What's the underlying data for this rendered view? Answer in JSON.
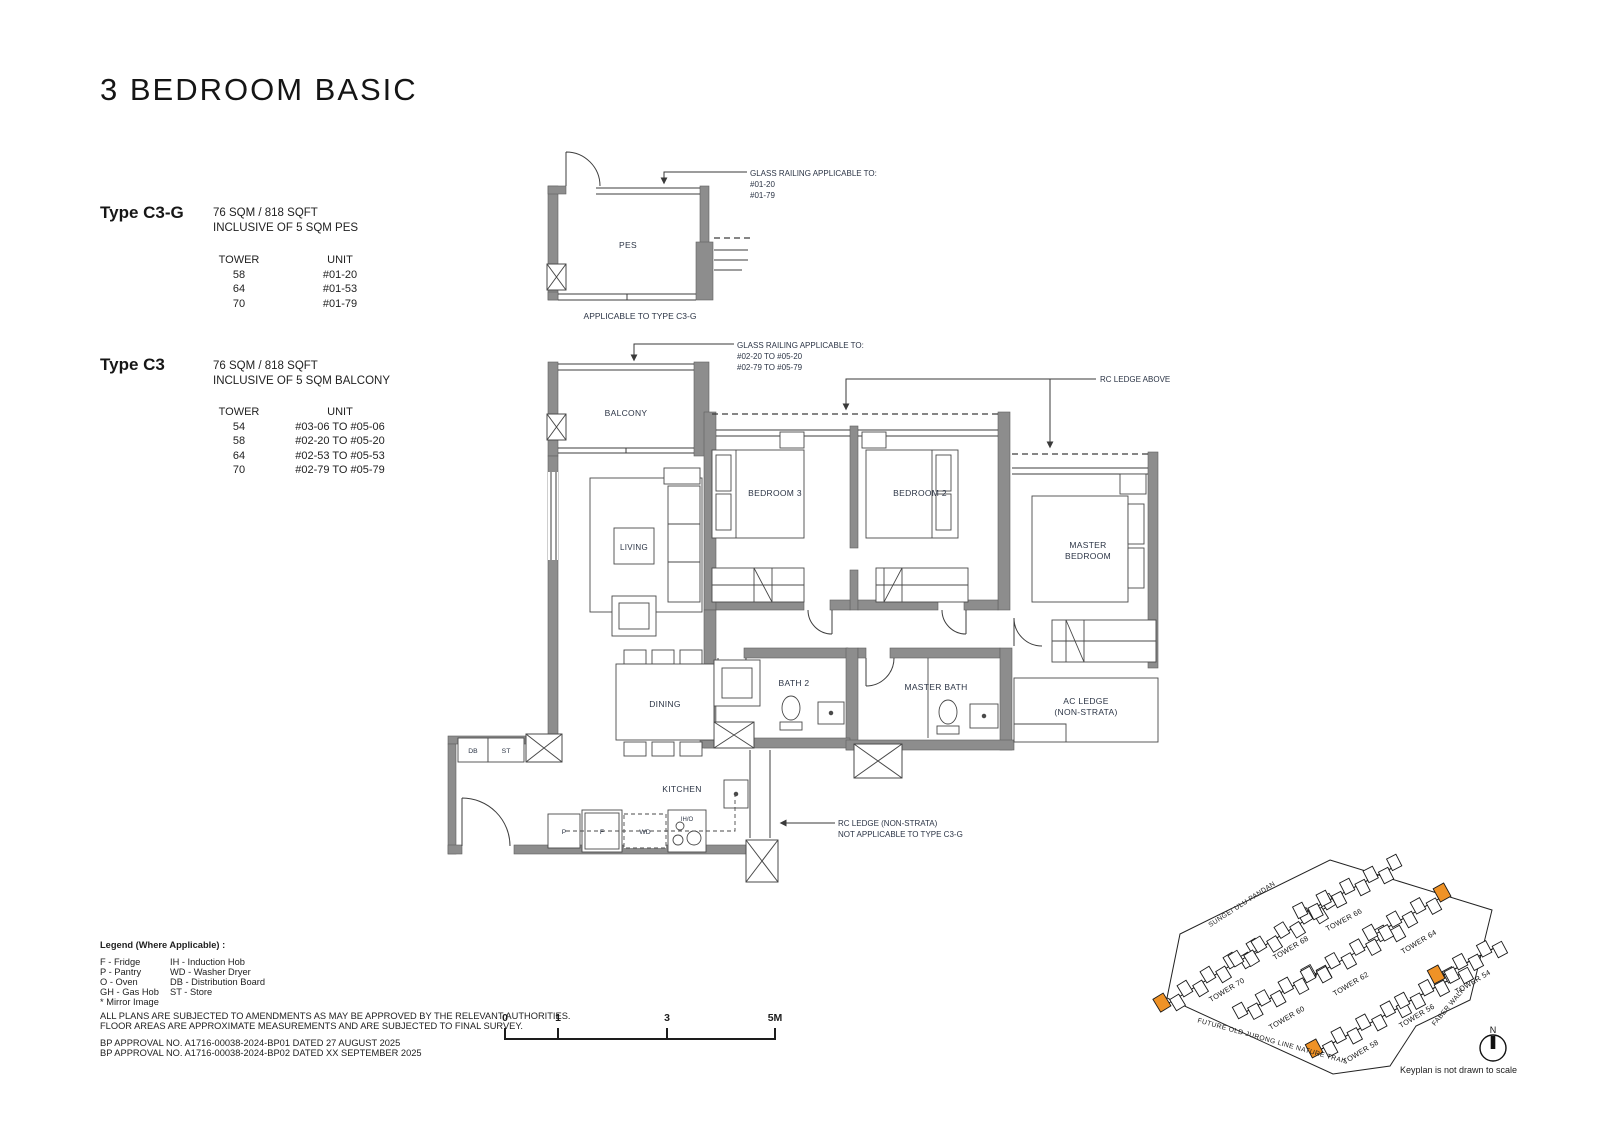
{
  "title": "3 BEDROOM BASIC",
  "unit_types": [
    {
      "name": "Type C3-G",
      "area": "76 SQM / 818 SQFT",
      "inclusive": "INCLUSIVE OF 5 SQM PES",
      "headers": {
        "tower": "TOWER",
        "unit": "UNIT"
      },
      "rows": [
        {
          "tower": "58",
          "unit": "#01-20"
        },
        {
          "tower": "64",
          "unit": "#01-53"
        },
        {
          "tower": "70",
          "unit": "#01-79"
        }
      ]
    },
    {
      "name": "Type C3",
      "area": "76 SQM / 818 SQFT",
      "inclusive": "INCLUSIVE OF 5 SQM BALCONY",
      "headers": {
        "tower": "TOWER",
        "unit": "UNIT"
      },
      "rows": [
        {
          "tower": "54",
          "unit": "#03-06 TO #05-06"
        },
        {
          "tower": "58",
          "unit": "#02-20 TO #05-20"
        },
        {
          "tower": "64",
          "unit": "#02-53 TO #05-53"
        },
        {
          "tower": "70",
          "unit": "#02-79 TO #05-79"
        }
      ]
    }
  ],
  "floorplan": {
    "rooms": {
      "pes": "PES",
      "balcony": "BALCONY",
      "living": "LIVING",
      "bedroom3": "BEDROOM 3",
      "bedroom2": "BEDROOM 2",
      "master1": "MASTER",
      "master2": "BEDROOM",
      "dining": "DINING",
      "bath2": "BATH 2",
      "master_bath": "MASTER BATH",
      "ac_ledge1": "AC LEDGE",
      "ac_ledge2": "(NON-STRATA)",
      "kitchen": "KITCHEN"
    },
    "fixtures": {
      "db": "DB",
      "st": "ST",
      "p": "P",
      "f": "F",
      "wd": "WD",
      "iho": "IH/O"
    },
    "annotations": {
      "pes_railing1": "GLASS RAILING APPLICABLE TO:",
      "pes_railing2": "#01-20",
      "pes_railing3": "#01-79",
      "applicable": "APPLICABLE TO TYPE C3-G",
      "bal_railing1": "GLASS RAILING APPLICABLE TO:",
      "bal_railing2": "#02-20 TO #05-20",
      "bal_railing3": "#02-79 TO #05-79",
      "rc_above": "RC LEDGE ABOVE",
      "rc_ns1": "RC LEDGE (NON-STRATA)",
      "rc_ns2": "NOT APPLICABLE TO TYPE C3-G"
    }
  },
  "legend": {
    "title": "Legend (Where Applicable) :",
    "col1": [
      "F - Fridge",
      "P - Pantry",
      "O - Oven",
      "GH - Gas Hob",
      "* Mirror Image"
    ],
    "col2": [
      "IH - Induction Hob",
      "WD - Washer Dryer",
      "DB - Distribution Board",
      "ST - Store"
    ]
  },
  "disclaimer": [
    "ALL PLANS ARE SUBJECTED TO AMENDMENTS AS MAY BE APPROVED BY THE RELEVANT AUTHORITIES.",
    "FLOOR AREAS ARE APPROXIMATE MEASUREMENTS AND ARE SUBJECTED TO FINAL SURVEY."
  ],
  "approvals": [
    "BP APPROVAL NO. A1716-00038-2024-BP01  DATED 27 AUGUST 2025",
    "BP APPROVAL NO. A1716-00038-2024-BP02  DATED XX SEPTEMBER 2025"
  ],
  "scalebar": {
    "t0": "0",
    "t1": "1",
    "t2": "3",
    "t3": "5M"
  },
  "keyplan": {
    "roads": {
      "top": "SUNGEI ULU PANDAN",
      "bottom": "FUTURE OLD JURONG LINE NATURE TRAIL",
      "right": "FABER WALK"
    },
    "towers": [
      "TOWER 70",
      "TOWER 68",
      "TOWER 66",
      "TOWER 60",
      "TOWER 62",
      "TOWER 64",
      "TOWER 58",
      "TOWER 56",
      "TOWER 54"
    ],
    "highlight_color": "#EF9226",
    "north": "N",
    "note": "Keyplan is not drawn to scale"
  }
}
